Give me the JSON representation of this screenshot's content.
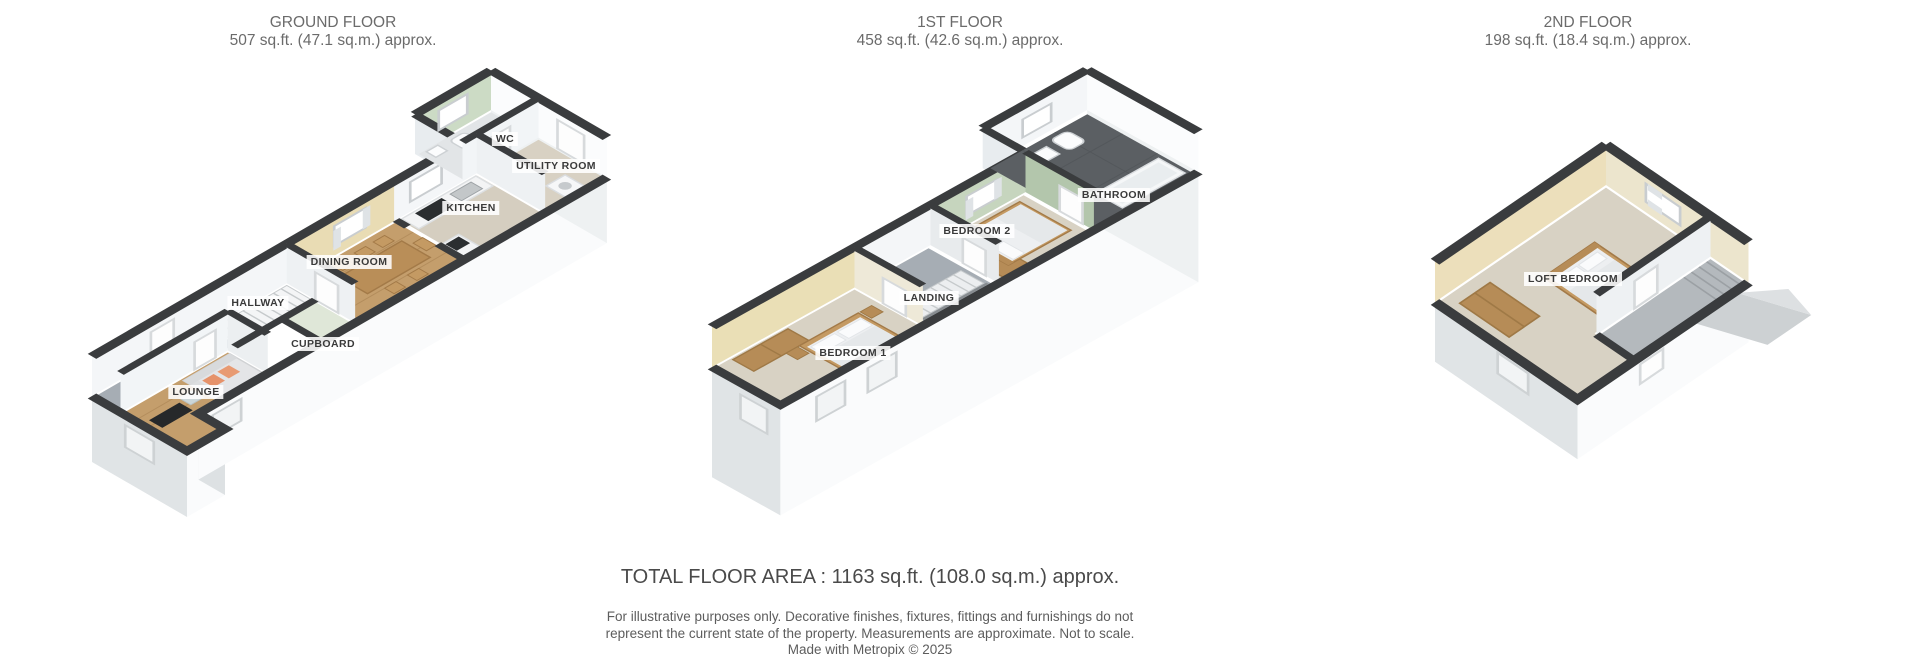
{
  "image_type": "3d-floorplan",
  "floors": [
    {
      "id": "ground",
      "title": "GROUND FLOOR",
      "area": "507 sq.ft. (47.1 sq.m.) approx.",
      "rooms": [
        {
          "name": "WC"
        },
        {
          "name": "UTILITY ROOM"
        },
        {
          "name": "KITCHEN"
        },
        {
          "name": "DINING ROOM"
        },
        {
          "name": "HALLWAY"
        },
        {
          "name": "CUPBOARD"
        },
        {
          "name": "LOUNGE"
        }
      ]
    },
    {
      "id": "first",
      "title": "1ST FLOOR",
      "area": "458 sq.ft. (42.6 sq.m.) approx.",
      "rooms": [
        {
          "name": "BATHROOM"
        },
        {
          "name": "BEDROOM 2"
        },
        {
          "name": "LANDING"
        },
        {
          "name": "BEDROOM 1"
        }
      ]
    },
    {
      "id": "second",
      "title": "2ND FLOOR",
      "area": "198 sq.ft. (18.4 sq.m.) approx.",
      "rooms": [
        {
          "name": "LOFT BEDROOM"
        }
      ]
    }
  ],
  "footer": {
    "total": "TOTAL FLOOR AREA : 1163 sq.ft. (108.0 sq.m.) approx.",
    "disclaimer_line1": "For illustrative purposes only. Decorative finishes, fixtures, fittings and furnishings do not",
    "disclaimer_line2": "represent the current state of the property. Measurements are approximate. Not to scale.",
    "disclaimer_line3": "Made with Metropix © 2025"
  },
  "colors": {
    "wall_top": "#3a3c3e",
    "exterior_wall_white": "#fafbfc",
    "exterior_wall_shaded": "#e0e4e6",
    "interior_wall": "#f2f5f7",
    "wood_floor": "#c49e6c",
    "carpet_floor": "#d8d2c4",
    "gray_floor": "#a6adb4",
    "kitchen_floor": "#d5cec0",
    "bathroom_tile": "#5b5f63",
    "green_wall": "#c6d5be",
    "beige_wall": "#e9dcb4",
    "furniture_wood": "#b68c57",
    "sofa_gray": "#e4e5e7",
    "cushion_orange": "#e6926a"
  }
}
